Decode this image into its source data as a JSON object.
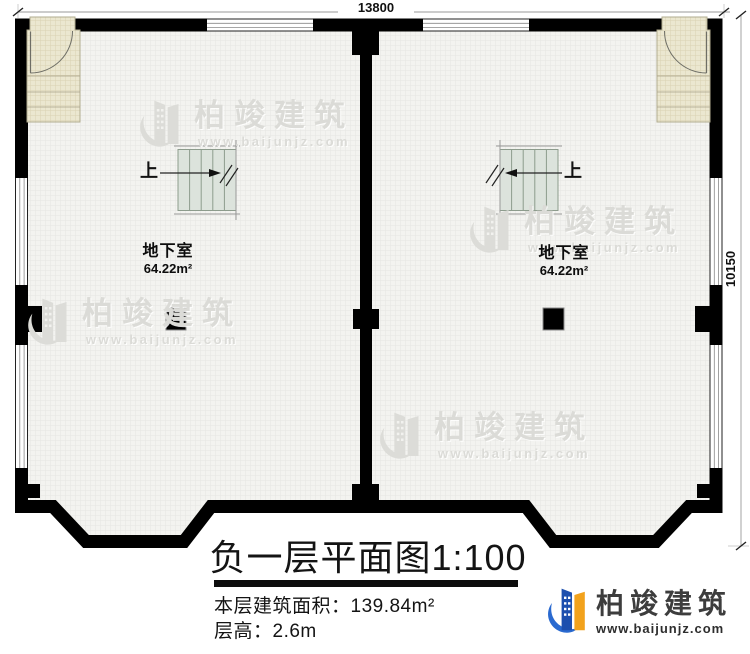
{
  "dimensions": {
    "top": "13800",
    "right": "10150"
  },
  "stairs": {
    "up": "上"
  },
  "rooms": [
    {
      "name": "地下室",
      "area": "64.22m²"
    },
    {
      "name": "地下室",
      "area": "64.22m²"
    }
  ],
  "watermark": {
    "brand": "柏竣建筑",
    "url": "www.baijunjz.com"
  },
  "title_block": {
    "title": "负一层平面图1:100",
    "area_line": "本层建筑面积：139.84m²",
    "floor_height_line": "层高：2.6m"
  },
  "footer_logo": {
    "brand": "柏竣建筑",
    "url": "www.baijunjz.com"
  },
  "colors": {
    "wall": "#000000",
    "floor": "#f3f3f0",
    "vestibule": "#ebe7d0",
    "stair_fill": "#dce3dc",
    "watermark": "#dbdbd7",
    "logo_blue": "#1c4fae",
    "logo_orange": "#f2a21c"
  }
}
